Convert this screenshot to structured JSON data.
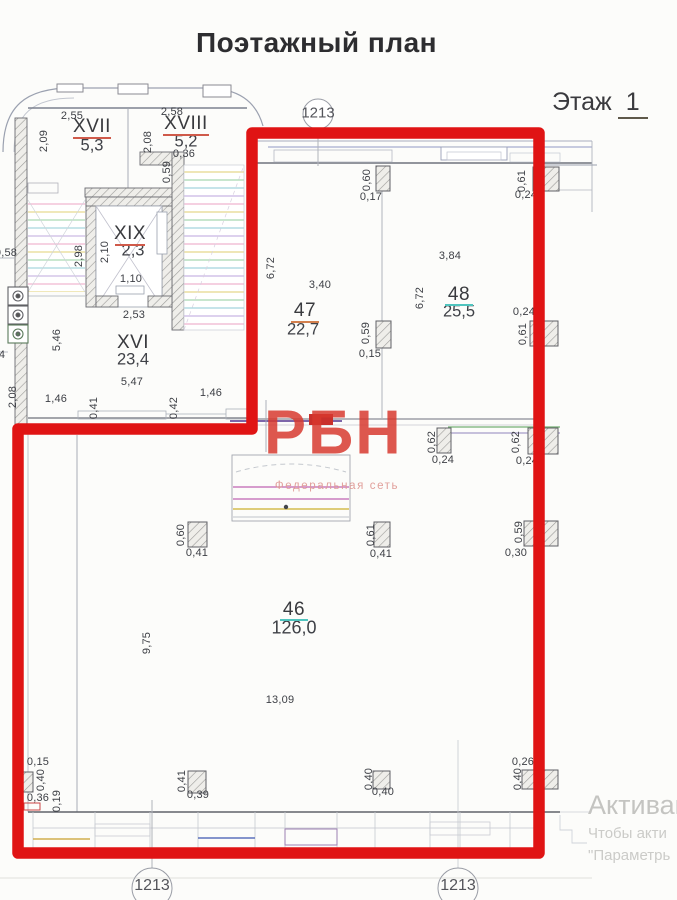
{
  "title": "Поэтажный план",
  "floor": {
    "label": "Этаж",
    "number": "1"
  },
  "axes": {
    "top": "1213",
    "bottom_left": "1213",
    "bottom_right": "1213"
  },
  "rooms": [
    {
      "num": "XVII",
      "area": "5,3"
    },
    {
      "num": "XVIII",
      "area": "5,2"
    },
    {
      "num": "XIX",
      "area": "2,3"
    },
    {
      "num": "XVI",
      "area": "23,4"
    },
    {
      "num": "47",
      "area": "22,7"
    },
    {
      "num": "48",
      "area": "25,5"
    },
    {
      "num": "46",
      "area": "126,0"
    }
  ],
  "dims": [
    {
      "t": "2,55"
    },
    {
      "t": "2,09"
    },
    {
      "t": "2,58"
    },
    {
      "t": "2,08"
    },
    {
      "t": "0,36"
    },
    {
      "t": "0,59"
    },
    {
      "t": "2,10"
    },
    {
      "t": "2,98"
    },
    {
      "t": "1,10"
    },
    {
      "t": "2,53"
    },
    {
      "t": "5,46"
    },
    {
      "t": "5,47"
    },
    {
      "t": "1,46"
    },
    {
      "t": "0,41"
    },
    {
      "t": "0,42"
    },
    {
      "t": "1,46"
    },
    {
      "t": "2,08"
    },
    {
      "t": "0,58"
    },
    {
      "t": "4"
    },
    {
      "t": "0,60"
    },
    {
      "t": "0,17"
    },
    {
      "t": "0,61"
    },
    {
      "t": "0,24"
    },
    {
      "t": "6,72"
    },
    {
      "t": "3,40"
    },
    {
      "t": "3,84"
    },
    {
      "t": "6,72"
    },
    {
      "t": "0,59"
    },
    {
      "t": "0,15"
    },
    {
      "t": "0,24"
    },
    {
      "t": "0,61"
    },
    {
      "t": "0,62"
    },
    {
      "t": "0,24"
    },
    {
      "t": "0,62"
    },
    {
      "t": "0,24"
    },
    {
      "t": "0,60"
    },
    {
      "t": "0,41"
    },
    {
      "t": "0,61"
    },
    {
      "t": "0,41"
    },
    {
      "t": "0,59"
    },
    {
      "t": "0,30"
    },
    {
      "t": "9,75"
    },
    {
      "t": "13,09"
    },
    {
      "t": "0,15"
    },
    {
      "t": "0,40"
    },
    {
      "t": "0,36"
    },
    {
      "t": "0,19"
    },
    {
      "t": "0,41"
    },
    {
      "t": "0,39"
    },
    {
      "t": "0,40"
    },
    {
      "t": "0,40"
    },
    {
      "t": "0,26"
    },
    {
      "t": "0,40"
    }
  ],
  "watermark": {
    "logo": "РБН",
    "tagline": "Федеральная сеть"
  },
  "activation": {
    "line1": "Активац",
    "line2": "Чтобы акти",
    "line3": "\"Параметрь"
  }
}
